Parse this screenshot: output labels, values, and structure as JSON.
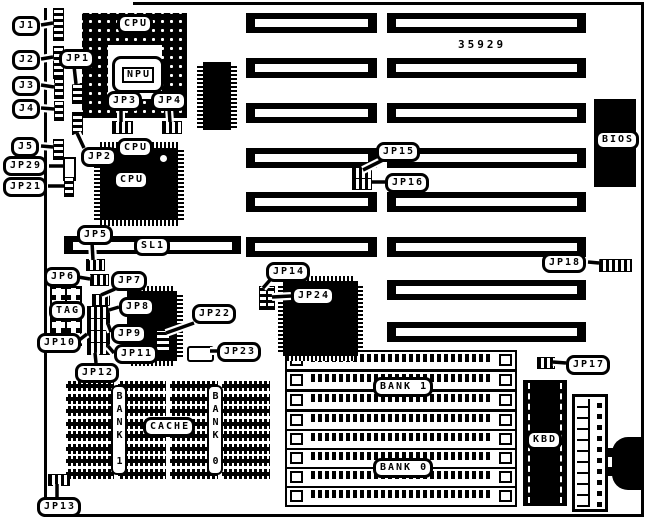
{
  "part_number": "35929",
  "labels": {
    "j1": "J1",
    "j2": "J2",
    "j3": "J3",
    "j4": "J4",
    "j5": "J5",
    "jp1": "JP1",
    "jp2": "JP2",
    "jp3": "JP3",
    "jp4": "JP4",
    "jp5": "JP5",
    "jp6": "JP6",
    "jp7": "JP7",
    "jp8": "JP8",
    "jp9": "JP9",
    "jp10": "JP10",
    "jp11": "JP11",
    "jp12": "JP12",
    "jp13": "JP13",
    "jp14": "JP14",
    "jp15": "JP15",
    "jp16": "JP16",
    "jp17": "JP17",
    "jp18": "JP18",
    "jp21": "JP21",
    "jp22": "JP22",
    "jp23": "JP23",
    "jp24": "JP24",
    "jp29": "JP29",
    "sl1": "SL1",
    "tag": "TAG"
  },
  "chips": {
    "cpu_socket": "CPU",
    "npu": "NPU",
    "cpu_top": "CPU",
    "cpu_center": "CPU",
    "bios": "BIOS",
    "kbd": "KBD",
    "cache": "CACHE",
    "bank1_simm": "BANK 1",
    "bank0_simm": "BANK 0",
    "bank1_cache": "BANK 1",
    "bank0_cache": "BANK 0"
  },
  "colors": {
    "line": "#000000",
    "background": "#ffffff"
  }
}
